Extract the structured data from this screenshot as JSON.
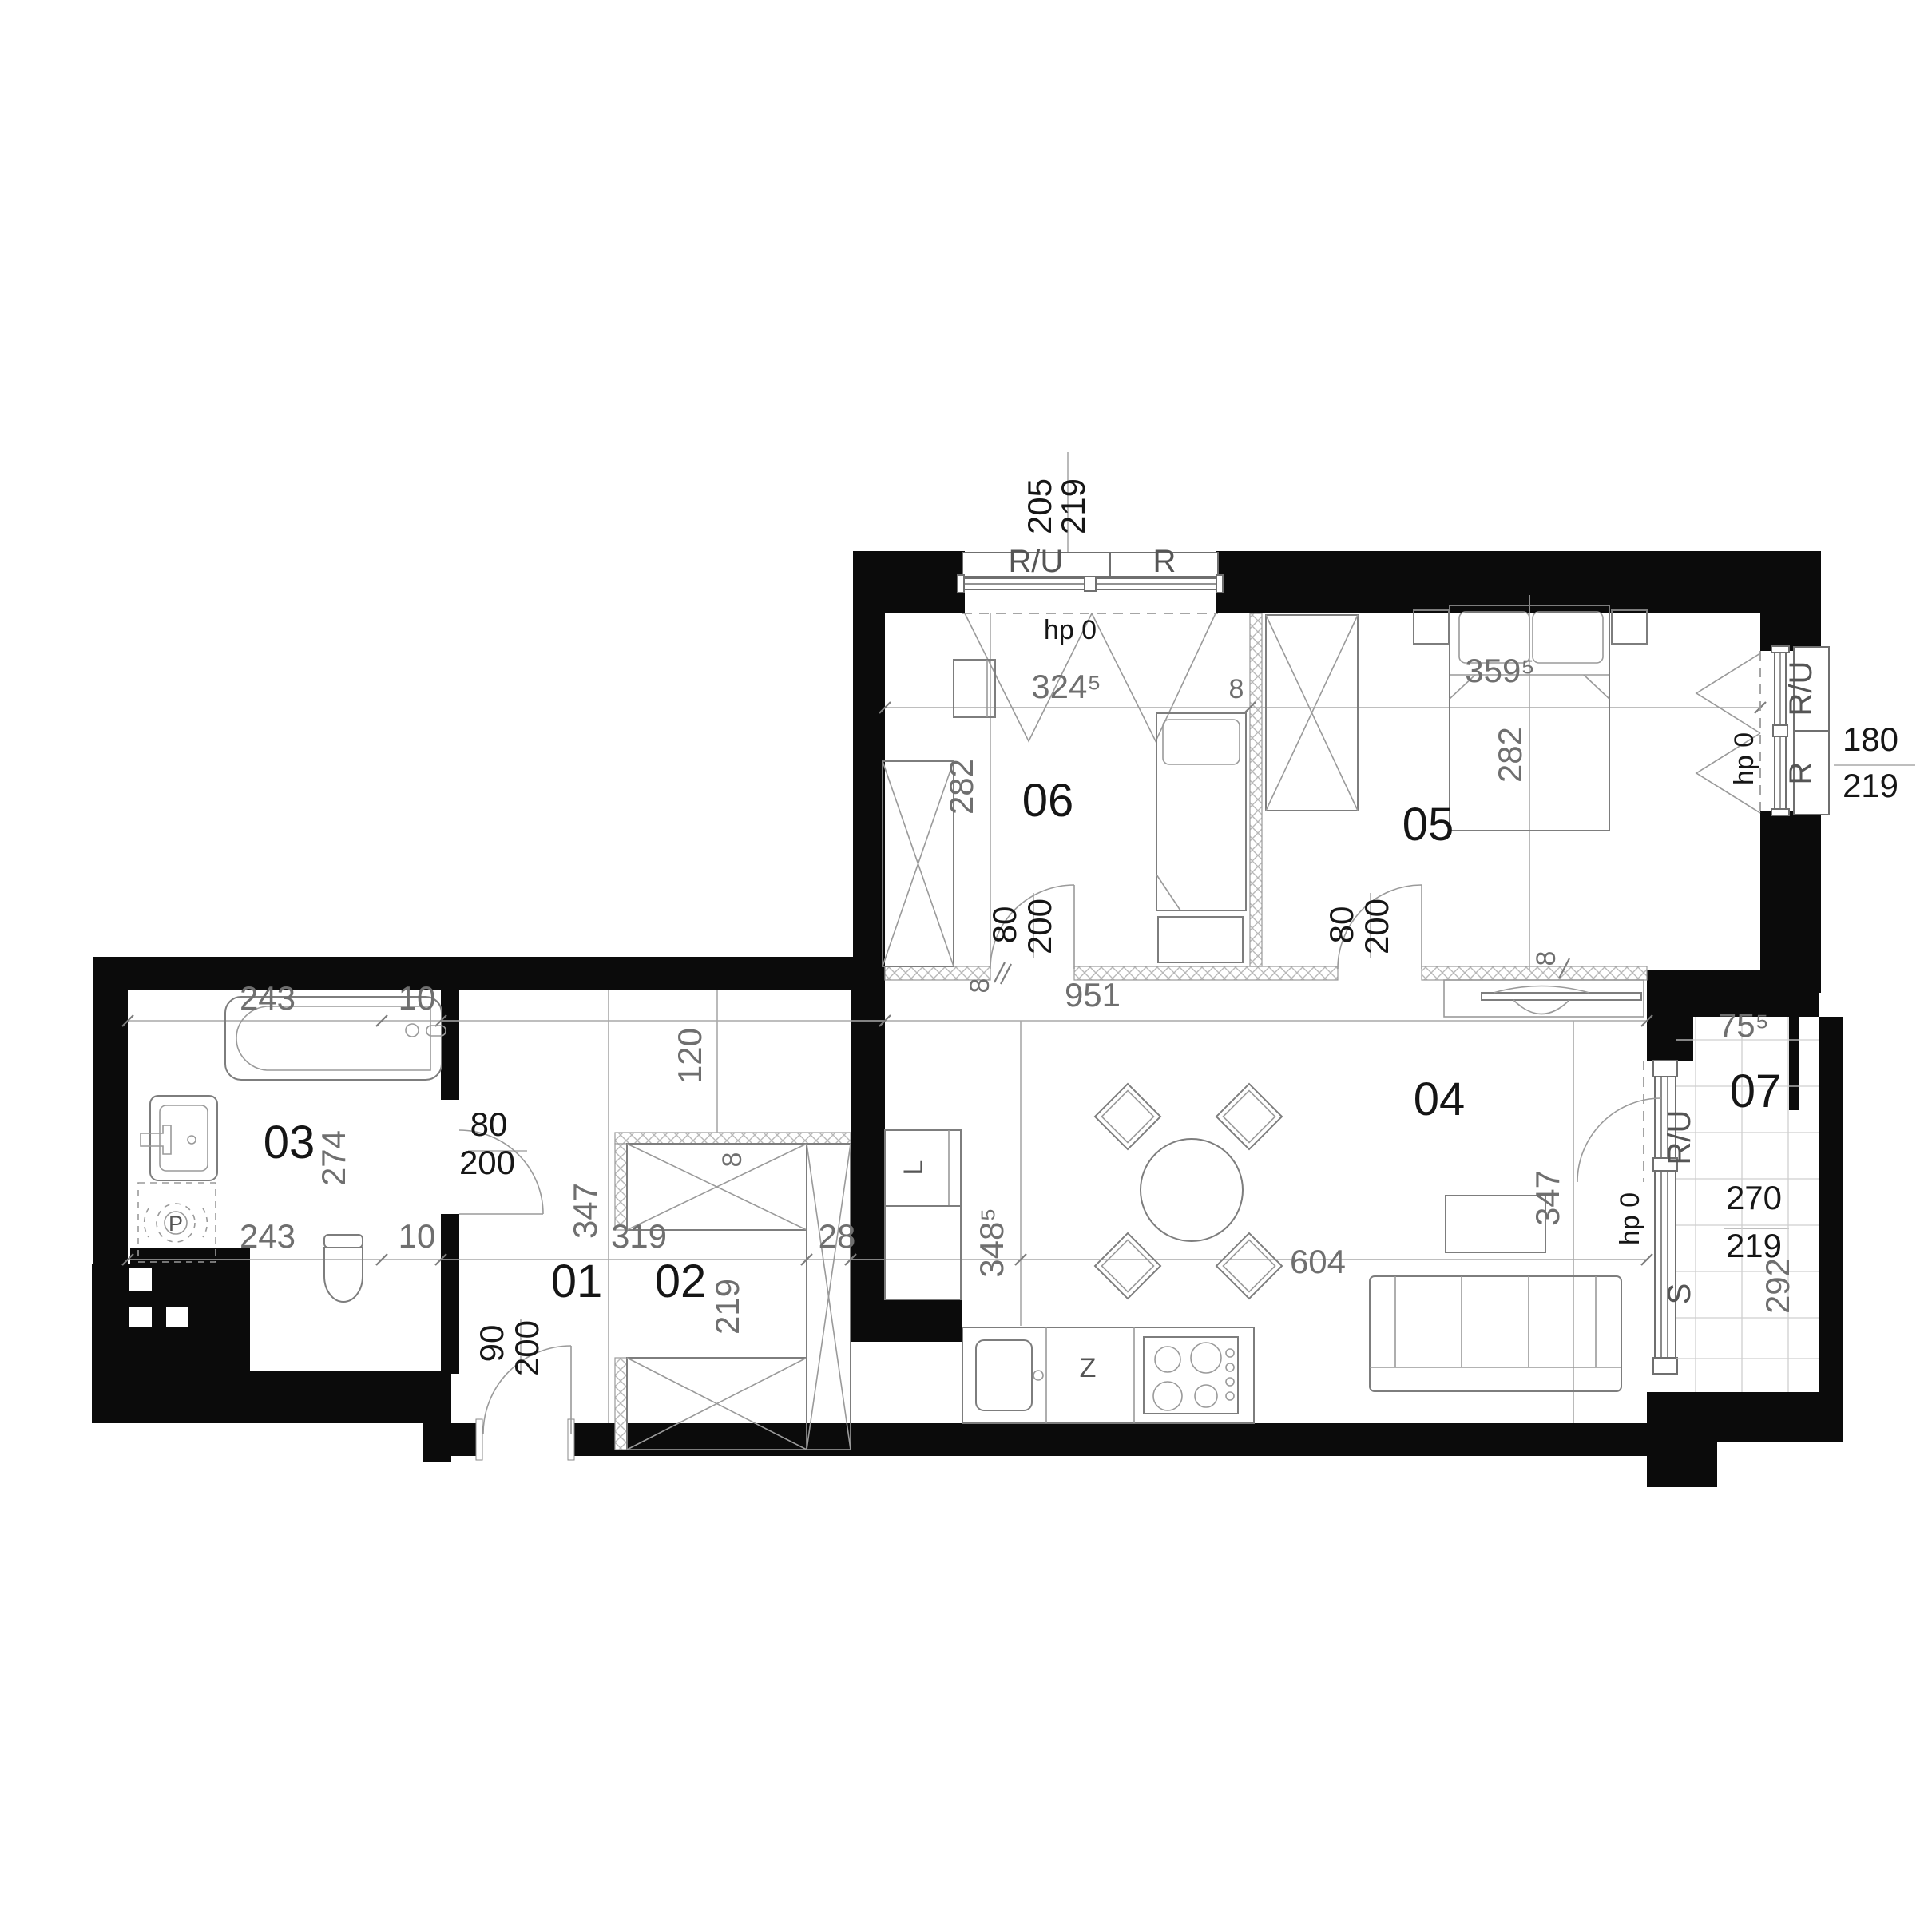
{
  "plan": {
    "rooms": {
      "r01": "01",
      "r02": "02",
      "r03": "03",
      "r04": "04",
      "r05": "05",
      "r06": "06",
      "r07": "07"
    },
    "door_dims": {
      "w80": "80",
      "w90": "90",
      "h200": "200"
    },
    "wall_dims": {
      "t8": "8"
    },
    "windows": {
      "top": {
        "label_left": "R/U",
        "label_right": "R",
        "w": "205",
        "h": "219",
        "hp": "hp 0"
      },
      "right": {
        "label_top": "R/U",
        "label_bottom": "R",
        "w": "180",
        "h": "219",
        "hp": "hp 0"
      },
      "balcony": {
        "label_top": "R/U",
        "label_bottom": "S",
        "w": "270",
        "h": "219",
        "hp": "hp 0"
      }
    },
    "dims": {
      "d324": "324⁵",
      "d359": "359⁵",
      "d348": "348⁵",
      "d75": "75⁵",
      "d282": "282",
      "d951": "951",
      "d120": "120",
      "d347": "347",
      "d319": "319",
      "d28": "28",
      "d219": "219",
      "d604": "604",
      "d243": "243",
      "d10": "10",
      "d274": "274",
      "d292": "292"
    },
    "labels": {
      "sink": "Z",
      "fridge": "L",
      "washer": "P"
    }
  }
}
